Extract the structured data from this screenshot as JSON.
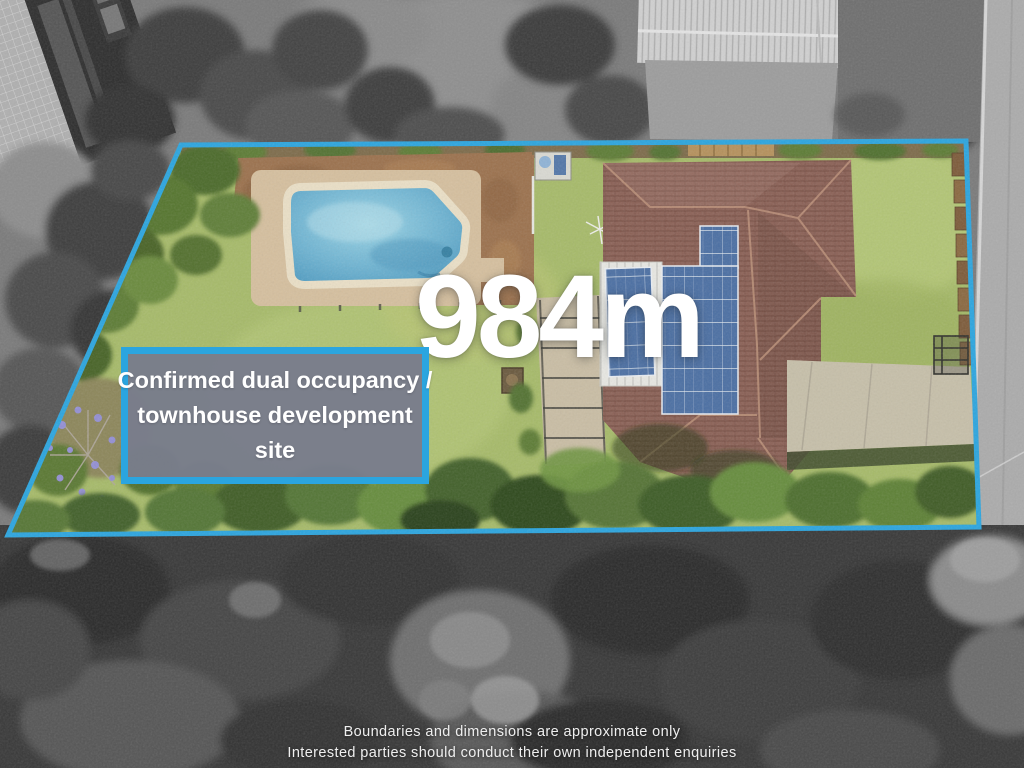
{
  "annotations": {
    "area_label": "984m",
    "callout_lines": [
      "Confirmed dual occupancy /",
      "townhouse development",
      "site"
    ],
    "disclaimer_lines": [
      "Boundaries and dimensions are approximate only",
      "Interested parties should conduct their own independent enquiries"
    ]
  },
  "colors": {
    "boundary_blue": "#2BA5DF",
    "callout_fill": "#797D8B",
    "callout_border": "#2BA5DF",
    "text_white": "#FFFFFF",
    "pool_water": "#5FA9CA",
    "roof_brown": "#8B6156",
    "solar_panel_blue": "#4B6FA3",
    "lawn_green": "#A6BA69"
  }
}
